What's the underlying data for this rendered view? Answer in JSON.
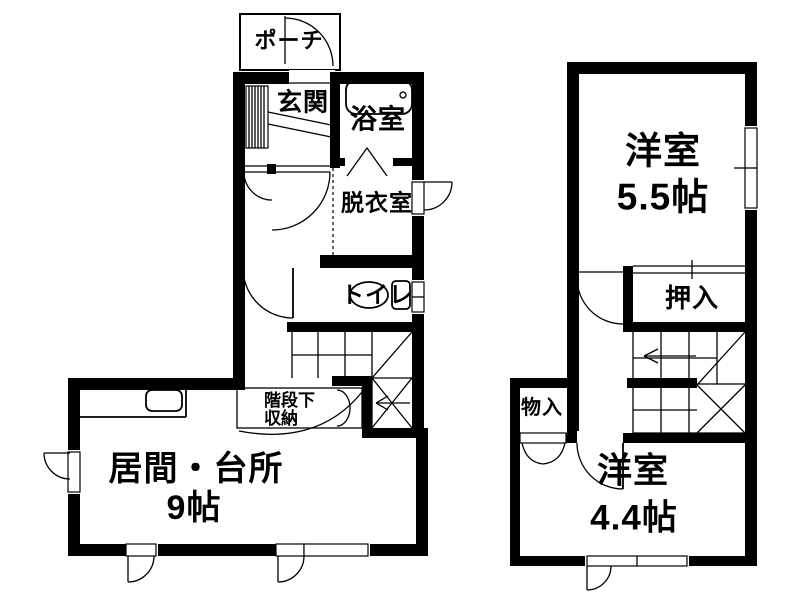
{
  "colors": {
    "wall": "#000000",
    "background": "#ffffff"
  },
  "floor1": {
    "porch": "ポーチ",
    "entrance": "玄関",
    "bathroom": "浴室",
    "dressing_room": "脱衣室",
    "toilet": "トイレ",
    "understair_line1": "階段下",
    "understair_line2": "収納",
    "living_name": "居間・台所",
    "living_size": "9帖"
  },
  "floor2": {
    "west_room_55_name": "洋室",
    "west_room_55_size": "5.5帖",
    "closet": "押入",
    "storage": "物入",
    "west_room_44_name": "洋室",
    "west_room_44_size": "4.4帖"
  }
}
